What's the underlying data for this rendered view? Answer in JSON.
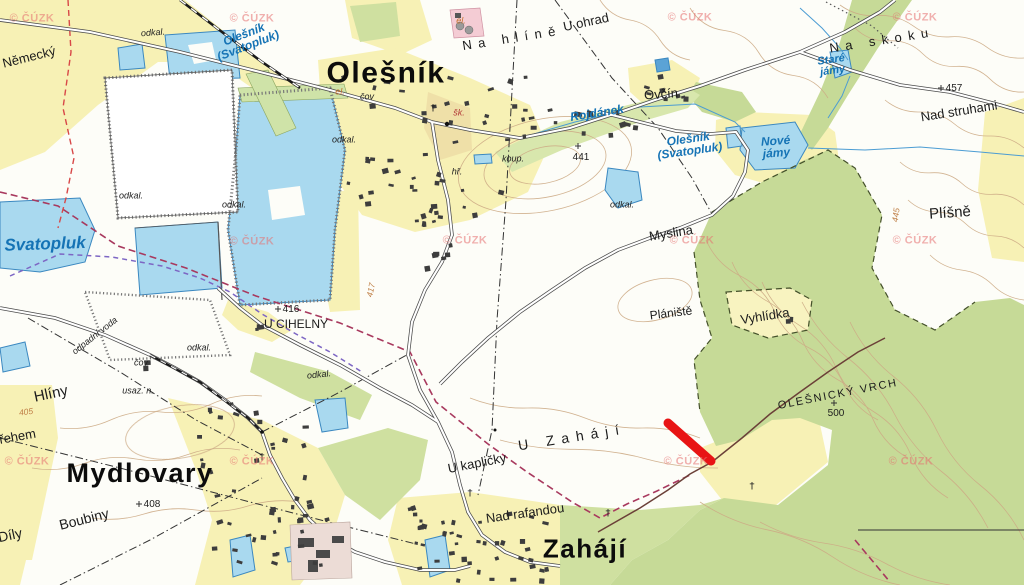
{
  "map": {
    "attribution": "© ČÚZK",
    "towns": [
      {
        "text": "Olešník",
        "x": 386,
        "y": 74,
        "size": 30,
        "rot": 0
      },
      {
        "text": "Mydlovary",
        "x": 140,
        "y": 474,
        "size": 27,
        "rot": 0
      },
      {
        "text": "Zahájí",
        "x": 585,
        "y": 549,
        "size": 26,
        "rot": 0
      }
    ],
    "places": [
      {
        "text": "Německý",
        "x": 29,
        "y": 57,
        "size": 13,
        "rot": -14
      },
      {
        "text": "Hlíny",
        "x": 51,
        "y": 394,
        "size": 15,
        "rot": -12
      },
      {
        "text": "Boubiny",
        "x": 84,
        "y": 519,
        "size": 14,
        "rot": -14
      },
      {
        "text": "ořehem",
        "x": 14,
        "y": 437,
        "size": 13,
        "rot": -10
      },
      {
        "text": "Díly",
        "x": 10,
        "y": 535,
        "size": 14,
        "rot": -12
      },
      {
        "text": "U ohrad",
        "x": 586,
        "y": 22,
        "size": 13,
        "rot": -12
      },
      {
        "text": "Na hlíně",
        "x": 512,
        "y": 38,
        "size": 13,
        "rot": -9,
        "spaced": true
      },
      {
        "text": "Na skoku",
        "x": 882,
        "y": 40,
        "size": 13,
        "rot": -9,
        "spaced": true
      },
      {
        "text": "Nad struhami",
        "x": 959,
        "y": 111,
        "size": 13,
        "rot": -9
      },
      {
        "text": "Plíšně",
        "x": 950,
        "y": 213,
        "size": 15,
        "rot": -4
      },
      {
        "text": "Myslina",
        "x": 671,
        "y": 233,
        "size": 13,
        "rot": -9
      },
      {
        "text": "Plániště",
        "x": 671,
        "y": 313,
        "size": 12,
        "rot": -7
      },
      {
        "text": "Vyhlídka",
        "x": 765,
        "y": 316,
        "size": 13,
        "rot": -9
      },
      {
        "text": "OLEŠNICKÝ VRCH",
        "x": 838,
        "y": 395,
        "size": 11,
        "rot": -11,
        "spaced_sm": true
      },
      {
        "text": "U Zahájí",
        "x": 572,
        "y": 437,
        "size": 14,
        "rot": -9,
        "spaced": true
      },
      {
        "text": "U kapličky",
        "x": 477,
        "y": 463,
        "size": 13,
        "rot": -11
      },
      {
        "text": "Nad rafandou",
        "x": 525,
        "y": 513,
        "size": 13,
        "rot": -8
      },
      {
        "text": "U CIHELNY",
        "x": 296,
        "y": 324,
        "size": 12,
        "rot": 0
      },
      {
        "text": "Ovčín",
        "x": 661,
        "y": 94,
        "size": 13,
        "rot": -4
      }
    ],
    "water_names": [
      {
        "text": "Olešník\n(Svatopluk)",
        "x": 246,
        "y": 40,
        "size": 12,
        "rot": -21
      },
      {
        "text": "Svatopluk",
        "x": 45,
        "y": 244,
        "size": 17,
        "rot": -2
      },
      {
        "text": "Rojdánek",
        "x": 597,
        "y": 113,
        "size": 12,
        "rot": -9
      },
      {
        "text": "Olešník\n(Svatopluk)",
        "x": 689,
        "y": 145,
        "size": 12,
        "rot": -8
      },
      {
        "text": "Nové\njámy",
        "x": 776,
        "y": 147,
        "size": 12,
        "rot": -4
      },
      {
        "text": "Staré\njámy",
        "x": 832,
        "y": 66,
        "size": 11,
        "rot": -8
      }
    ],
    "small_labels": [
      {
        "text": "odkal.",
        "x": 153,
        "y": 33,
        "rot": -4
      },
      {
        "text": "odkal.",
        "x": 131,
        "y": 196,
        "rot": 0
      },
      {
        "text": "odkal.",
        "x": 234,
        "y": 205,
        "rot": 0
      },
      {
        "text": "odkal.",
        "x": 344,
        "y": 140,
        "rot": 0
      },
      {
        "text": "odkal.",
        "x": 199,
        "y": 348,
        "rot": 0
      },
      {
        "text": "odkal.",
        "x": 319,
        "y": 375,
        "rot": -6
      },
      {
        "text": "odkal.",
        "x": 622,
        "y": 205,
        "rot": 0
      },
      {
        "text": "čov",
        "x": 367,
        "y": 97,
        "rot": 0
      },
      {
        "text": "čov",
        "x": 141,
        "y": 363,
        "rot": 0
      },
      {
        "text": "el.",
        "x": 340,
        "y": 92,
        "rot": 0,
        "cls": "orange"
      },
      {
        "text": "el.",
        "x": 461,
        "y": 21,
        "rot": 0,
        "cls": "orange"
      },
      {
        "text": "koup.",
        "x": 513,
        "y": 159,
        "rot": 0
      },
      {
        "text": "hř.",
        "x": 457,
        "y": 172,
        "rot": 0
      },
      {
        "text": "šk.",
        "x": 459,
        "y": 113,
        "rot": 0,
        "cls": "red"
      },
      {
        "text": "usaz. n.",
        "x": 138,
        "y": 391,
        "rot": 0
      },
      {
        "text": "odpadní voda",
        "x": 95,
        "y": 336,
        "rot": -38
      }
    ],
    "contour_labels": [
      {
        "text": "405",
        "x": 26,
        "y": 412,
        "rot": -8
      },
      {
        "text": "445",
        "x": 896,
        "y": 215,
        "rot": -83
      },
      {
        "text": "417",
        "x": 371,
        "y": 290,
        "rot": -78
      }
    ],
    "elevations": [
      {
        "value": "416",
        "x": 291,
        "y": 310,
        "sx": 278,
        "sy": 309
      },
      {
        "value": "441",
        "x": 581,
        "y": 158,
        "sx": 578,
        "sy": 146
      },
      {
        "value": "457",
        "x": 954,
        "y": 89,
        "sx": 941,
        "sy": 88
      },
      {
        "value": "500",
        "x": 836,
        "y": 414,
        "sx": 834,
        "sy": 403
      },
      {
        "value": "408",
        "x": 152,
        "y": 505,
        "sx": 139,
        "sy": 504
      }
    ],
    "watermarks": [
      {
        "x": 32,
        "y": 19
      },
      {
        "x": 252,
        "y": 19
      },
      {
        "x": 690,
        "y": 18
      },
      {
        "x": 915,
        "y": 18
      },
      {
        "x": 252,
        "y": 242
      },
      {
        "x": 465,
        "y": 241
      },
      {
        "x": 692,
        "y": 241
      },
      {
        "x": 915,
        "y": 241
      },
      {
        "x": 27,
        "y": 462
      },
      {
        "x": 252,
        "y": 462
      },
      {
        "x": 686,
        "y": 462
      },
      {
        "x": 911,
        "y": 462
      }
    ],
    "highlight": {
      "x1": 668,
      "y1": 423,
      "x2": 711,
      "y2": 461,
      "width": 9,
      "color": "#e81414"
    },
    "palette": {
      "field": "#f7f1b5",
      "forest": "#c6da97",
      "valley_green": "#d8e7ad",
      "water_fill": "#a9d9ef",
      "water_edge": "#3b88c0",
      "contour": "#cdab86",
      "label_blue": "#1573b5",
      "highlight_red": "#e81414",
      "watermark_pink": "#e57070",
      "boundary_crimson": "#a8395e",
      "boundary_purple": "#7d66c4",
      "boundary_red": "#d84848"
    }
  }
}
